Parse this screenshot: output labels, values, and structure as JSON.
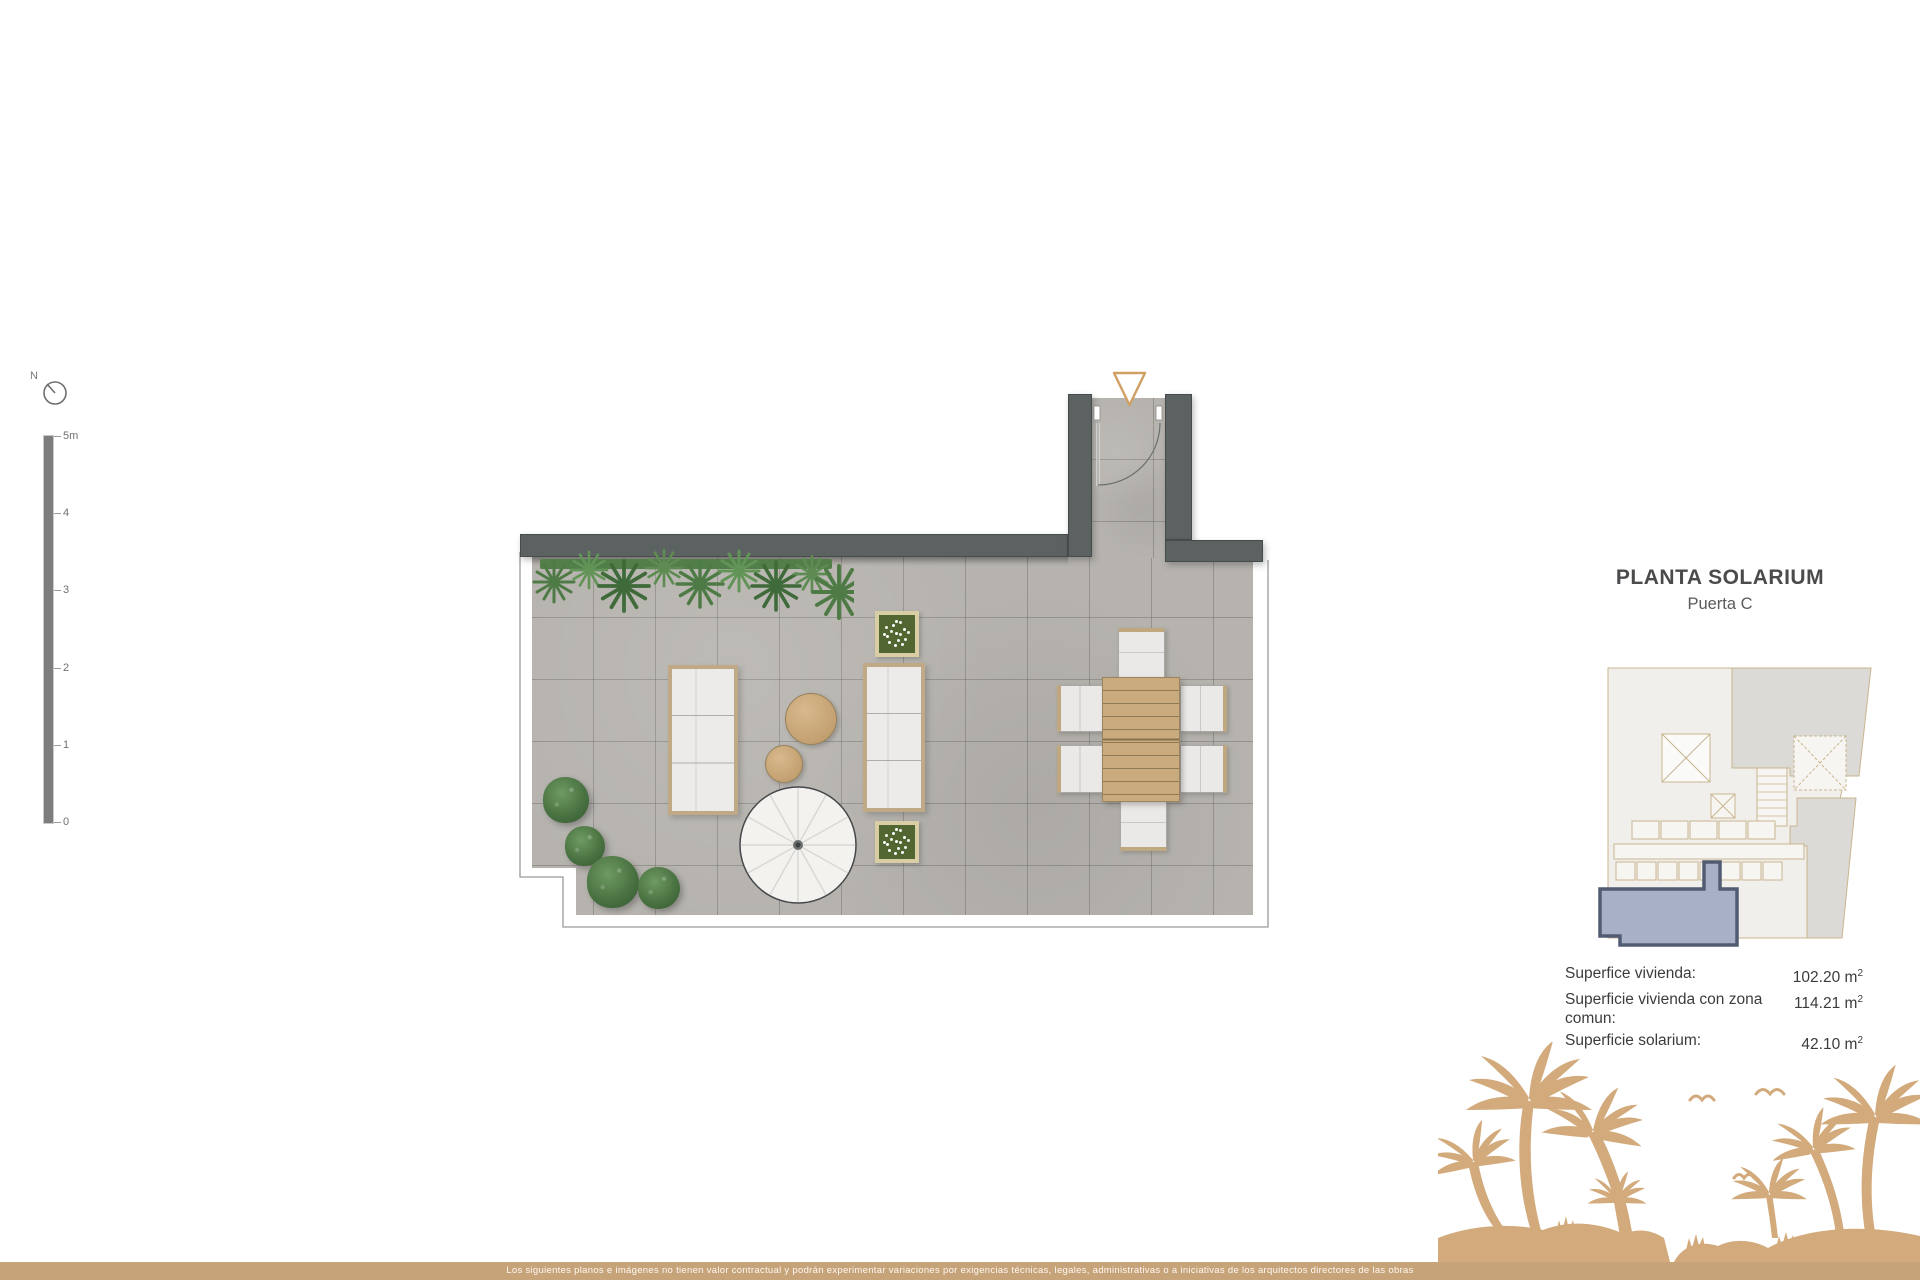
{
  "colors": {
    "accent_tan": "#d2aa7c",
    "footer_tan": "#c7a379",
    "wall_gray": "#5c6161",
    "floor_gray": "#b6b3ae",
    "plan_green": "#527e49",
    "key_highlight": "#a7b0c6",
    "key_highlight_border": "#515b72",
    "text_dark": "#4a4b4d"
  },
  "compass": {
    "north_label": "N",
    "icon": "compass-icon"
  },
  "scalebar": {
    "labels": [
      "5m",
      "4",
      "3",
      "2",
      "1",
      "0"
    ]
  },
  "plan": {
    "entrance_marker_icon": "triangle-down-icon",
    "door_icon": "door-swing-icon"
  },
  "panel": {
    "title": "PLANTA SOLARIUM",
    "subtitle": "Puerta C",
    "areas": [
      {
        "label": "Superfice vivienda:",
        "value": "102.20",
        "unit": "m",
        "sup": "2"
      },
      {
        "label": "Superficie vivienda con zona comun:",
        "value": "114.21",
        "unit": "m",
        "sup": "2"
      },
      {
        "label": "Superficie solarium:",
        "value": "42.10",
        "unit": "m",
        "sup": "2"
      }
    ]
  },
  "footer": {
    "disclaimer": "Los siguientes planos e imágenes no tienen valor contractual y podrán experimentar variaciones por exigencias técnicas, legales, administrativas o a iniciativas de los arquitectos directores de las obras"
  }
}
